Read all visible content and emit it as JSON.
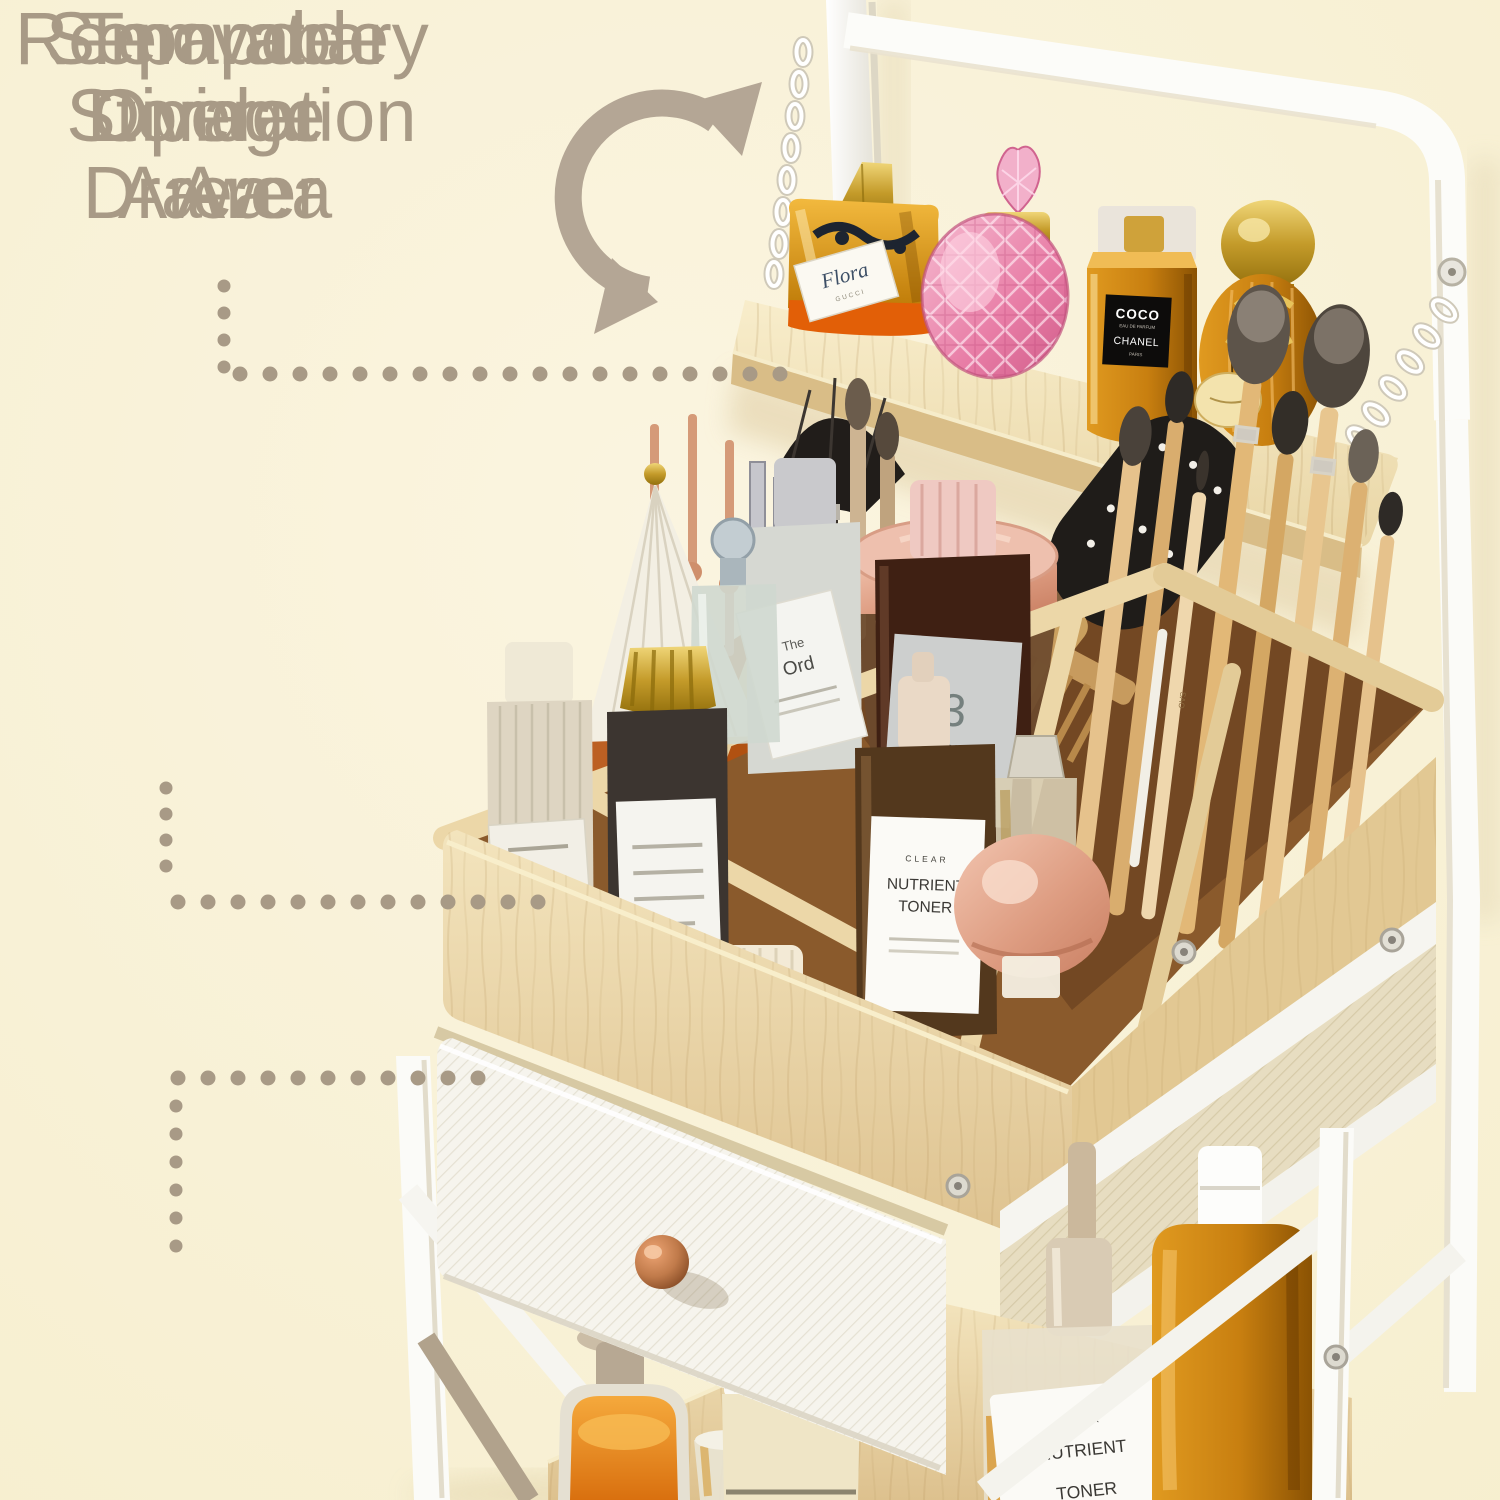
{
  "colors": {
    "background": "#f9f2d8",
    "annotation_text": "#a89a86",
    "leader_dots": "#a89a86",
    "rotate_arrow": "#b4a695",
    "wood": "#e9d5a8",
    "frame_white": "#fcfcfa",
    "drawer_knob_copper": "#c07a4a",
    "amber_glass": "#d8921e"
  },
  "annotations": {
    "labels": [
      {
        "id": "temporary-operation-area",
        "lines": [
          "Temporary",
          "Operation",
          "Area"
        ]
      },
      {
        "id": "separate-storage-area",
        "lines": [
          "Separate",
          "Storage",
          "Area"
        ]
      },
      {
        "id": "removable-divider-drawer",
        "lines": [
          "Removable",
          "Divider",
          "Drawer"
        ]
      }
    ],
    "rotate_arrow_icon": "curved double-headed rotation arrow",
    "leader_style": "dotted"
  },
  "product": {
    "perfume_coco": {
      "line1": "COCO",
      "line2": "EAU DE PARFUM",
      "line3": "CHANEL",
      "line4": "PARIS"
    },
    "perfume_flora": {
      "script": "Flora",
      "sub": "GUCCI"
    },
    "perfume_imperatrice": {
      "number": "3",
      "name": "L'IMPÉRATRICE"
    },
    "toner_pump": {
      "line1": "CLEAR",
      "line2": "NUTRIENT",
      "line3": "TONER"
    },
    "toner_dropper": {
      "line1": "CLEAR",
      "line2": "NUTRIENT",
      "line3": "TONER"
    },
    "ordinary_bottle": {
      "line1": "The",
      "line2": "Ord"
    },
    "fleurs_bottle": {
      "line1": "FLEURS"
    },
    "brush_handle_text": "SAO"
  }
}
